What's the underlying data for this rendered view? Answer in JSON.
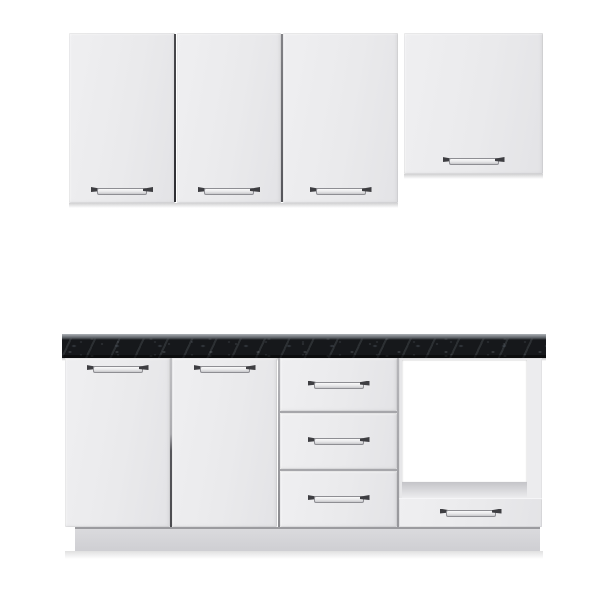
{
  "scene": {
    "type": "product-photo",
    "subject": "white kitchen cabinet set with dark marble countertop and open appliance compartment",
    "text_content": "none"
  },
  "palette": {
    "background": "#ffffff",
    "door_face": "#eaeaec",
    "door_face_light": "#efeff1",
    "door_edge": "#d3d3d6",
    "gap_light": "#b6b6ba",
    "countertop_base": "#16181b",
    "countertop_top_edge": "#aeb3b8",
    "handle_bar_light": "#fafafa",
    "handle_bar_dark": "#c7c7cb",
    "handle_outline": "#8e8e93",
    "handle_cap": "#3e3e42",
    "cavity_white": "#ffffff",
    "frame_face": "#ececee",
    "shelf_dark": "#c4c4c8",
    "plinth_top": "#dadadd",
    "plinth_bottom": "#cfcfd3",
    "plinth_edge": "#9b9b9f",
    "shadow": "rgba(70,70,75,0.25)"
  },
  "inventory": {
    "wall_cabinets": {
      "doors": 4,
      "handles": 4,
      "tall_doors": 3,
      "short_doors": 1
    },
    "base_cabinet": {
      "doors": 2,
      "drawers": 3,
      "appliance_compartment": 1,
      "appliance_drawer": 1,
      "countertop_finish": "black marble",
      "plinth": 1
    }
  }
}
